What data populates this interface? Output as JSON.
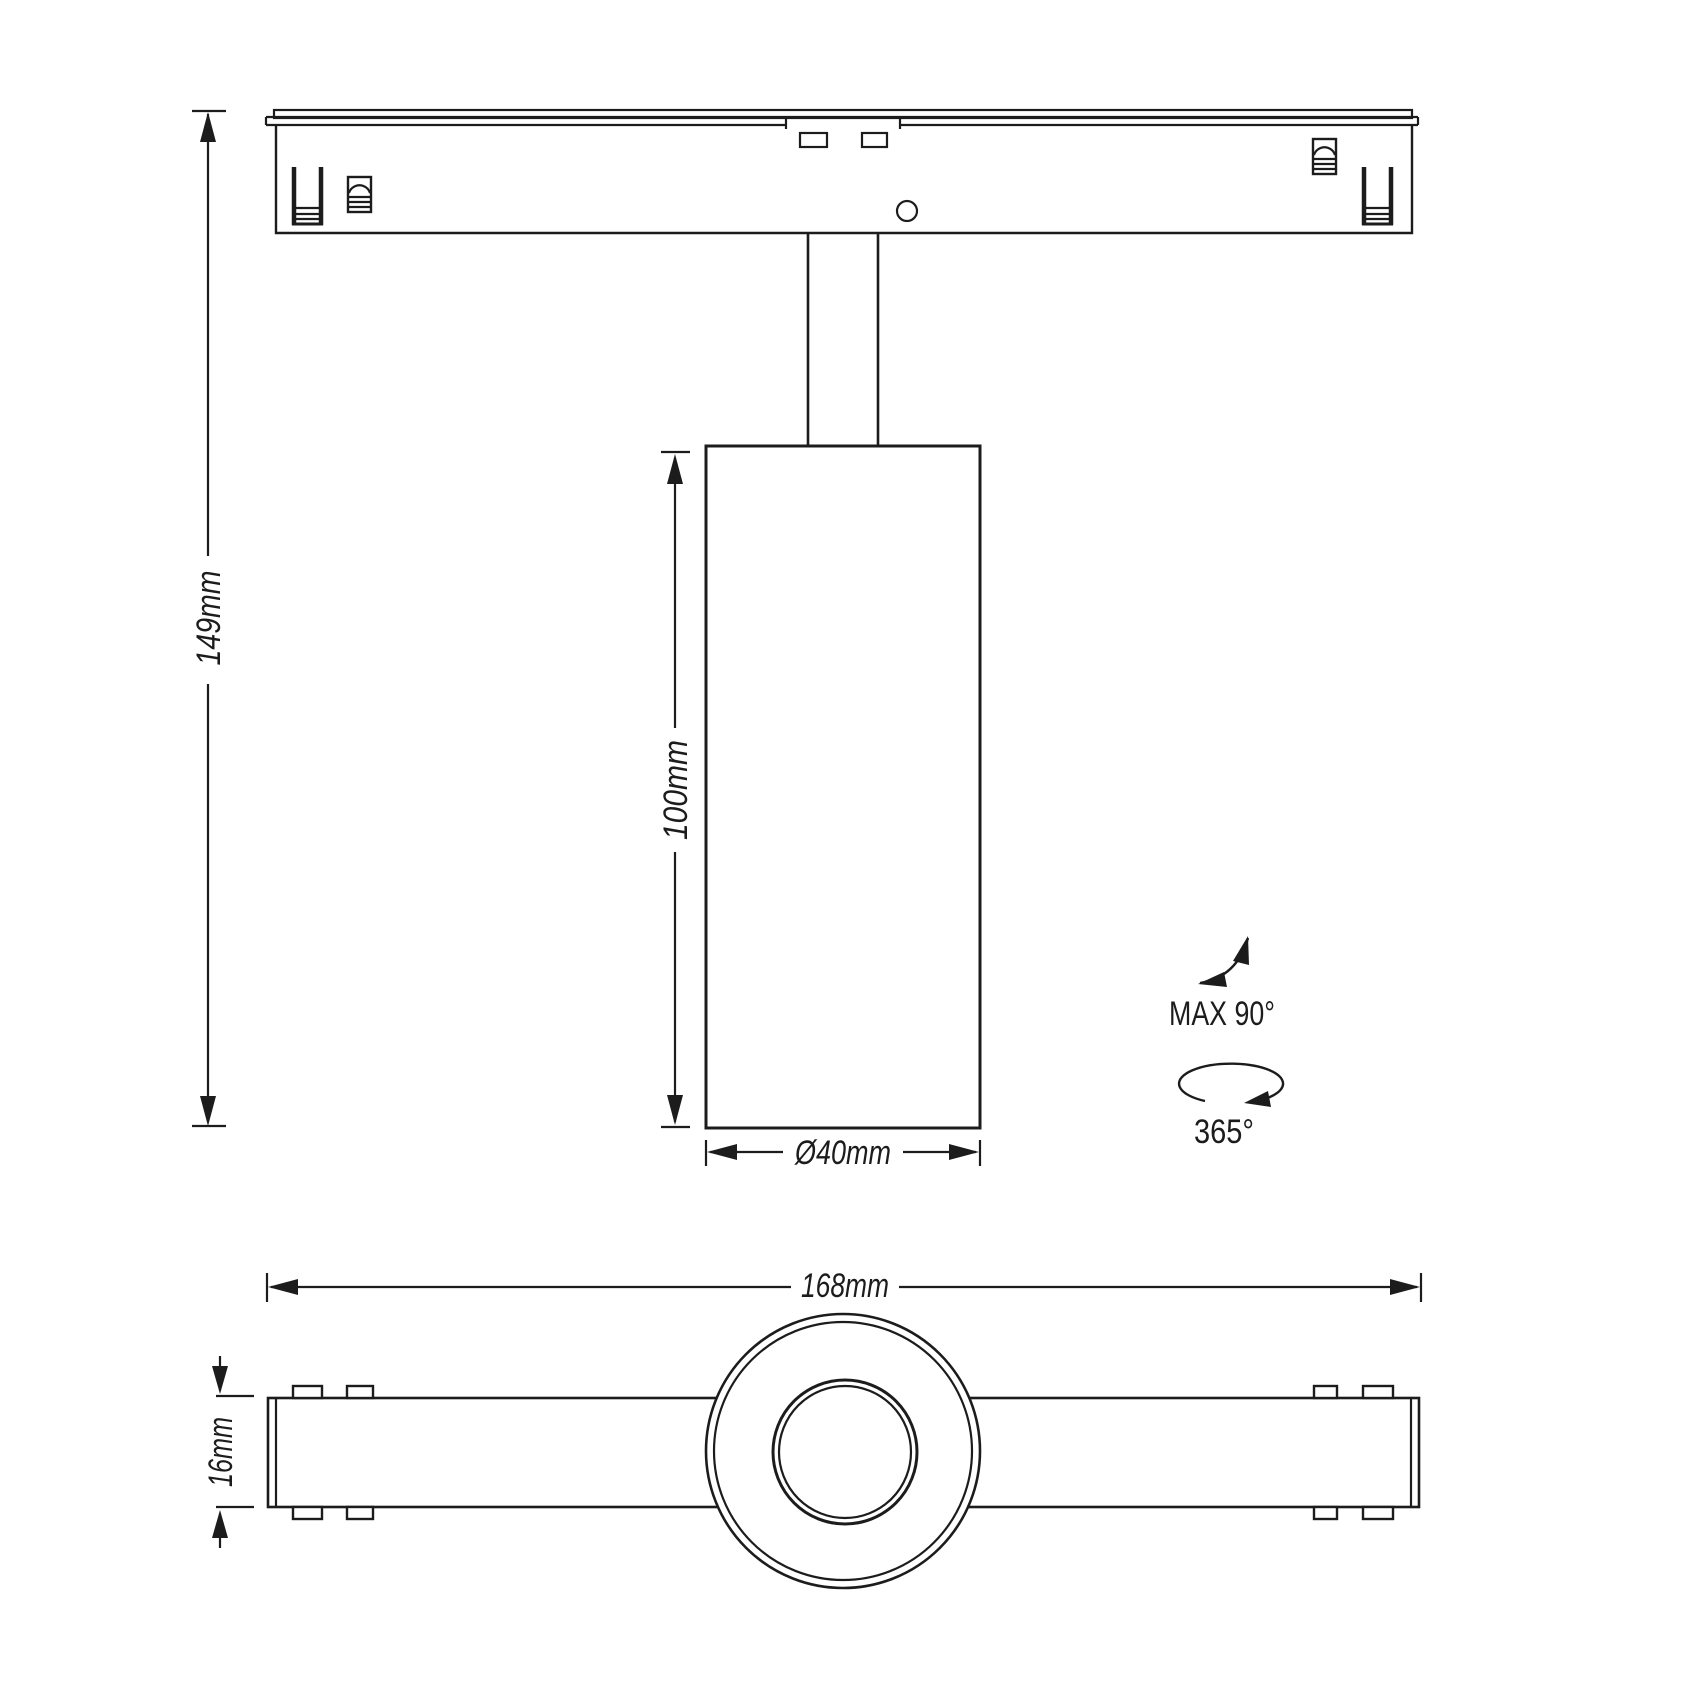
{
  "drawing_title": "magnetic-track-spotlight-dimension-drawing",
  "colors": {
    "line": "#1c1c1c",
    "background": "#ffffff"
  },
  "side_view": {
    "dim_height": "149mm",
    "dim_body_length": "100mm",
    "dim_diameter": "Ø40mm"
  },
  "annotations": {
    "tilt_label": "MAX 90°",
    "rotation_label": "365°"
  },
  "bottom_view": {
    "dim_length": "168mm",
    "dim_thickness": "16mm"
  }
}
